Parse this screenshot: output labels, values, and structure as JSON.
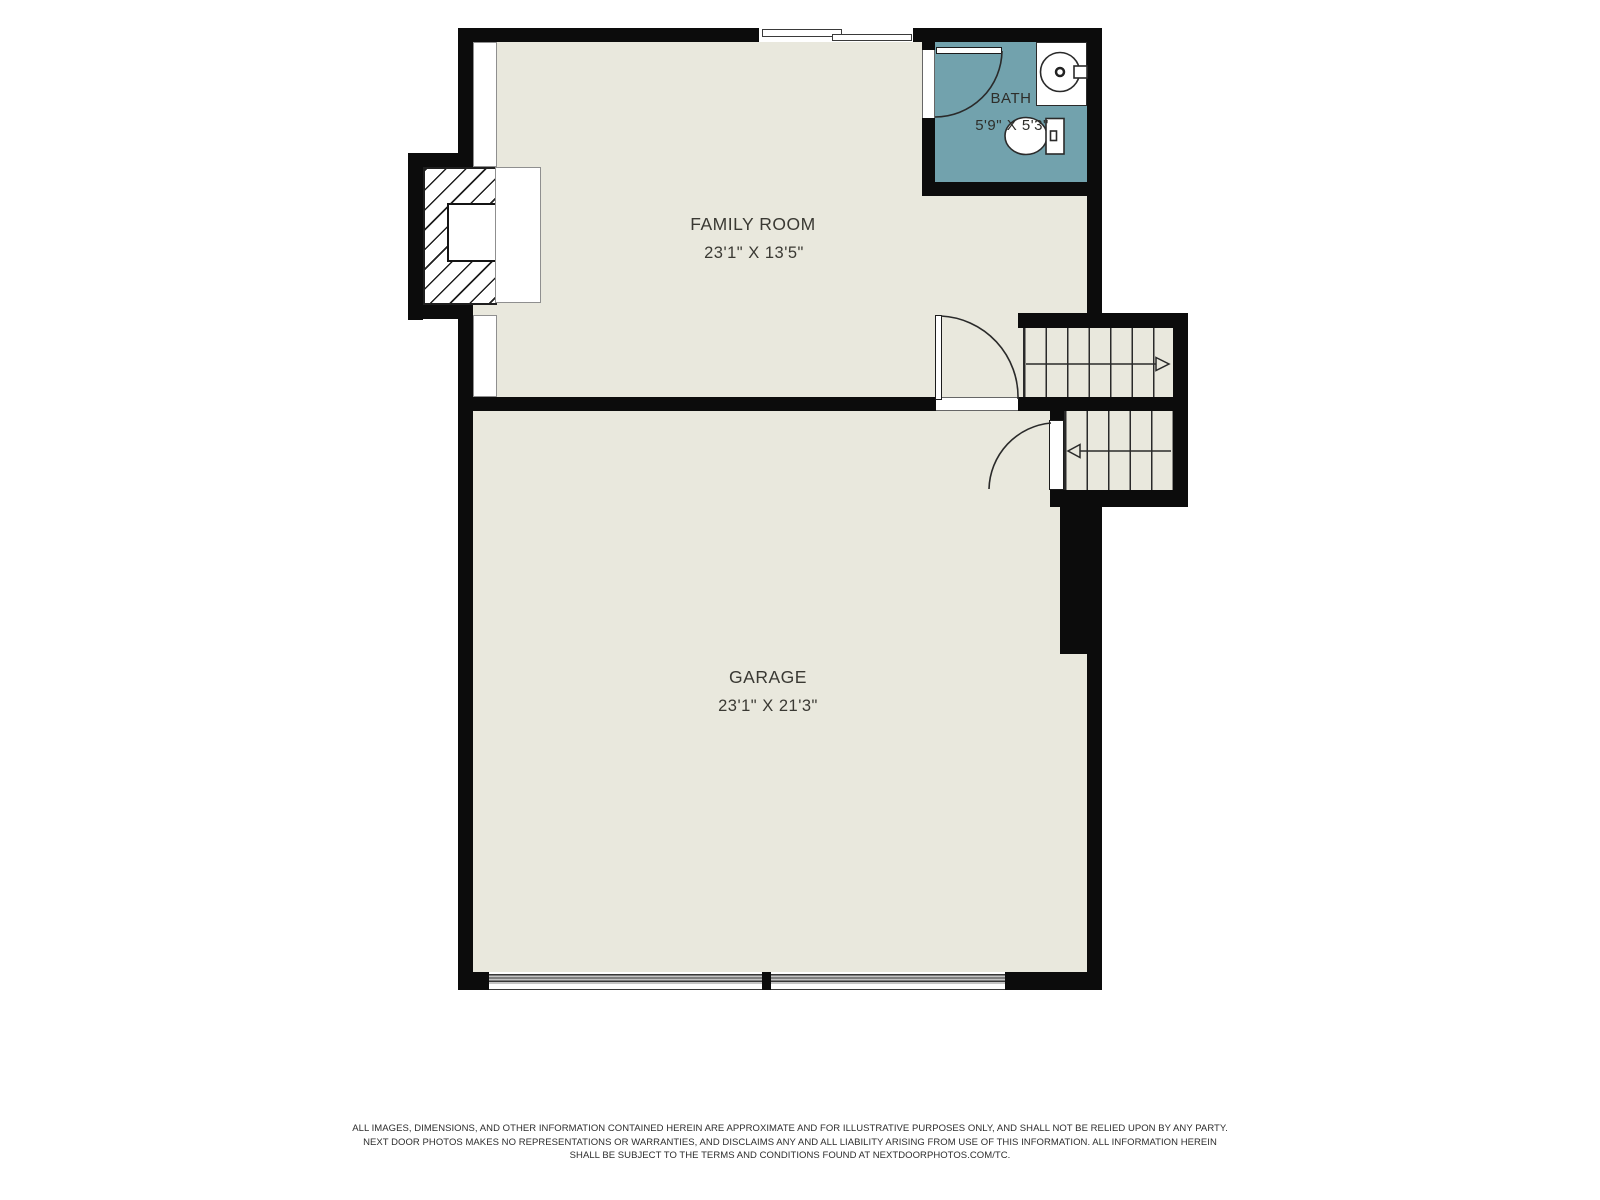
{
  "plan": {
    "rooms": {
      "family_room": {
        "name": "FAMILY ROOM",
        "dims": "23'1\" X 13'5\""
      },
      "garage": {
        "name": "GARAGE",
        "dims": "23'1\" X 21'3\""
      },
      "bath": {
        "name": "BATH",
        "dims": "5'9\" X 5'3\""
      }
    }
  },
  "footer": {
    "line1": "ALL IMAGES, DIMENSIONS, AND OTHER INFORMATION CONTAINED HEREIN ARE APPROXIMATE AND FOR ILLUSTRATIVE PURPOSES ONLY, AND SHALL NOT BE RELIED UPON BY ANY PARTY.",
    "line2": "NEXT DOOR PHOTOS MAKES NO REPRESENTATIONS OR WARRANTIES, AND DISCLAIMS ANY AND ALL LIABILITY ARISING FROM USE OF THIS INFORMATION. ALL INFORMATION HEREIN",
    "line3": "SHALL BE SUBJECT TO THE TERMS AND CONDITIONS FOUND AT NEXTDOORPHOTOS.COM/TC."
  },
  "colors": {
    "wall": "#0c0c0c",
    "floor": "#e9e8dd",
    "bath_floor": "#72a2ad",
    "line": "#2a2a2a"
  }
}
